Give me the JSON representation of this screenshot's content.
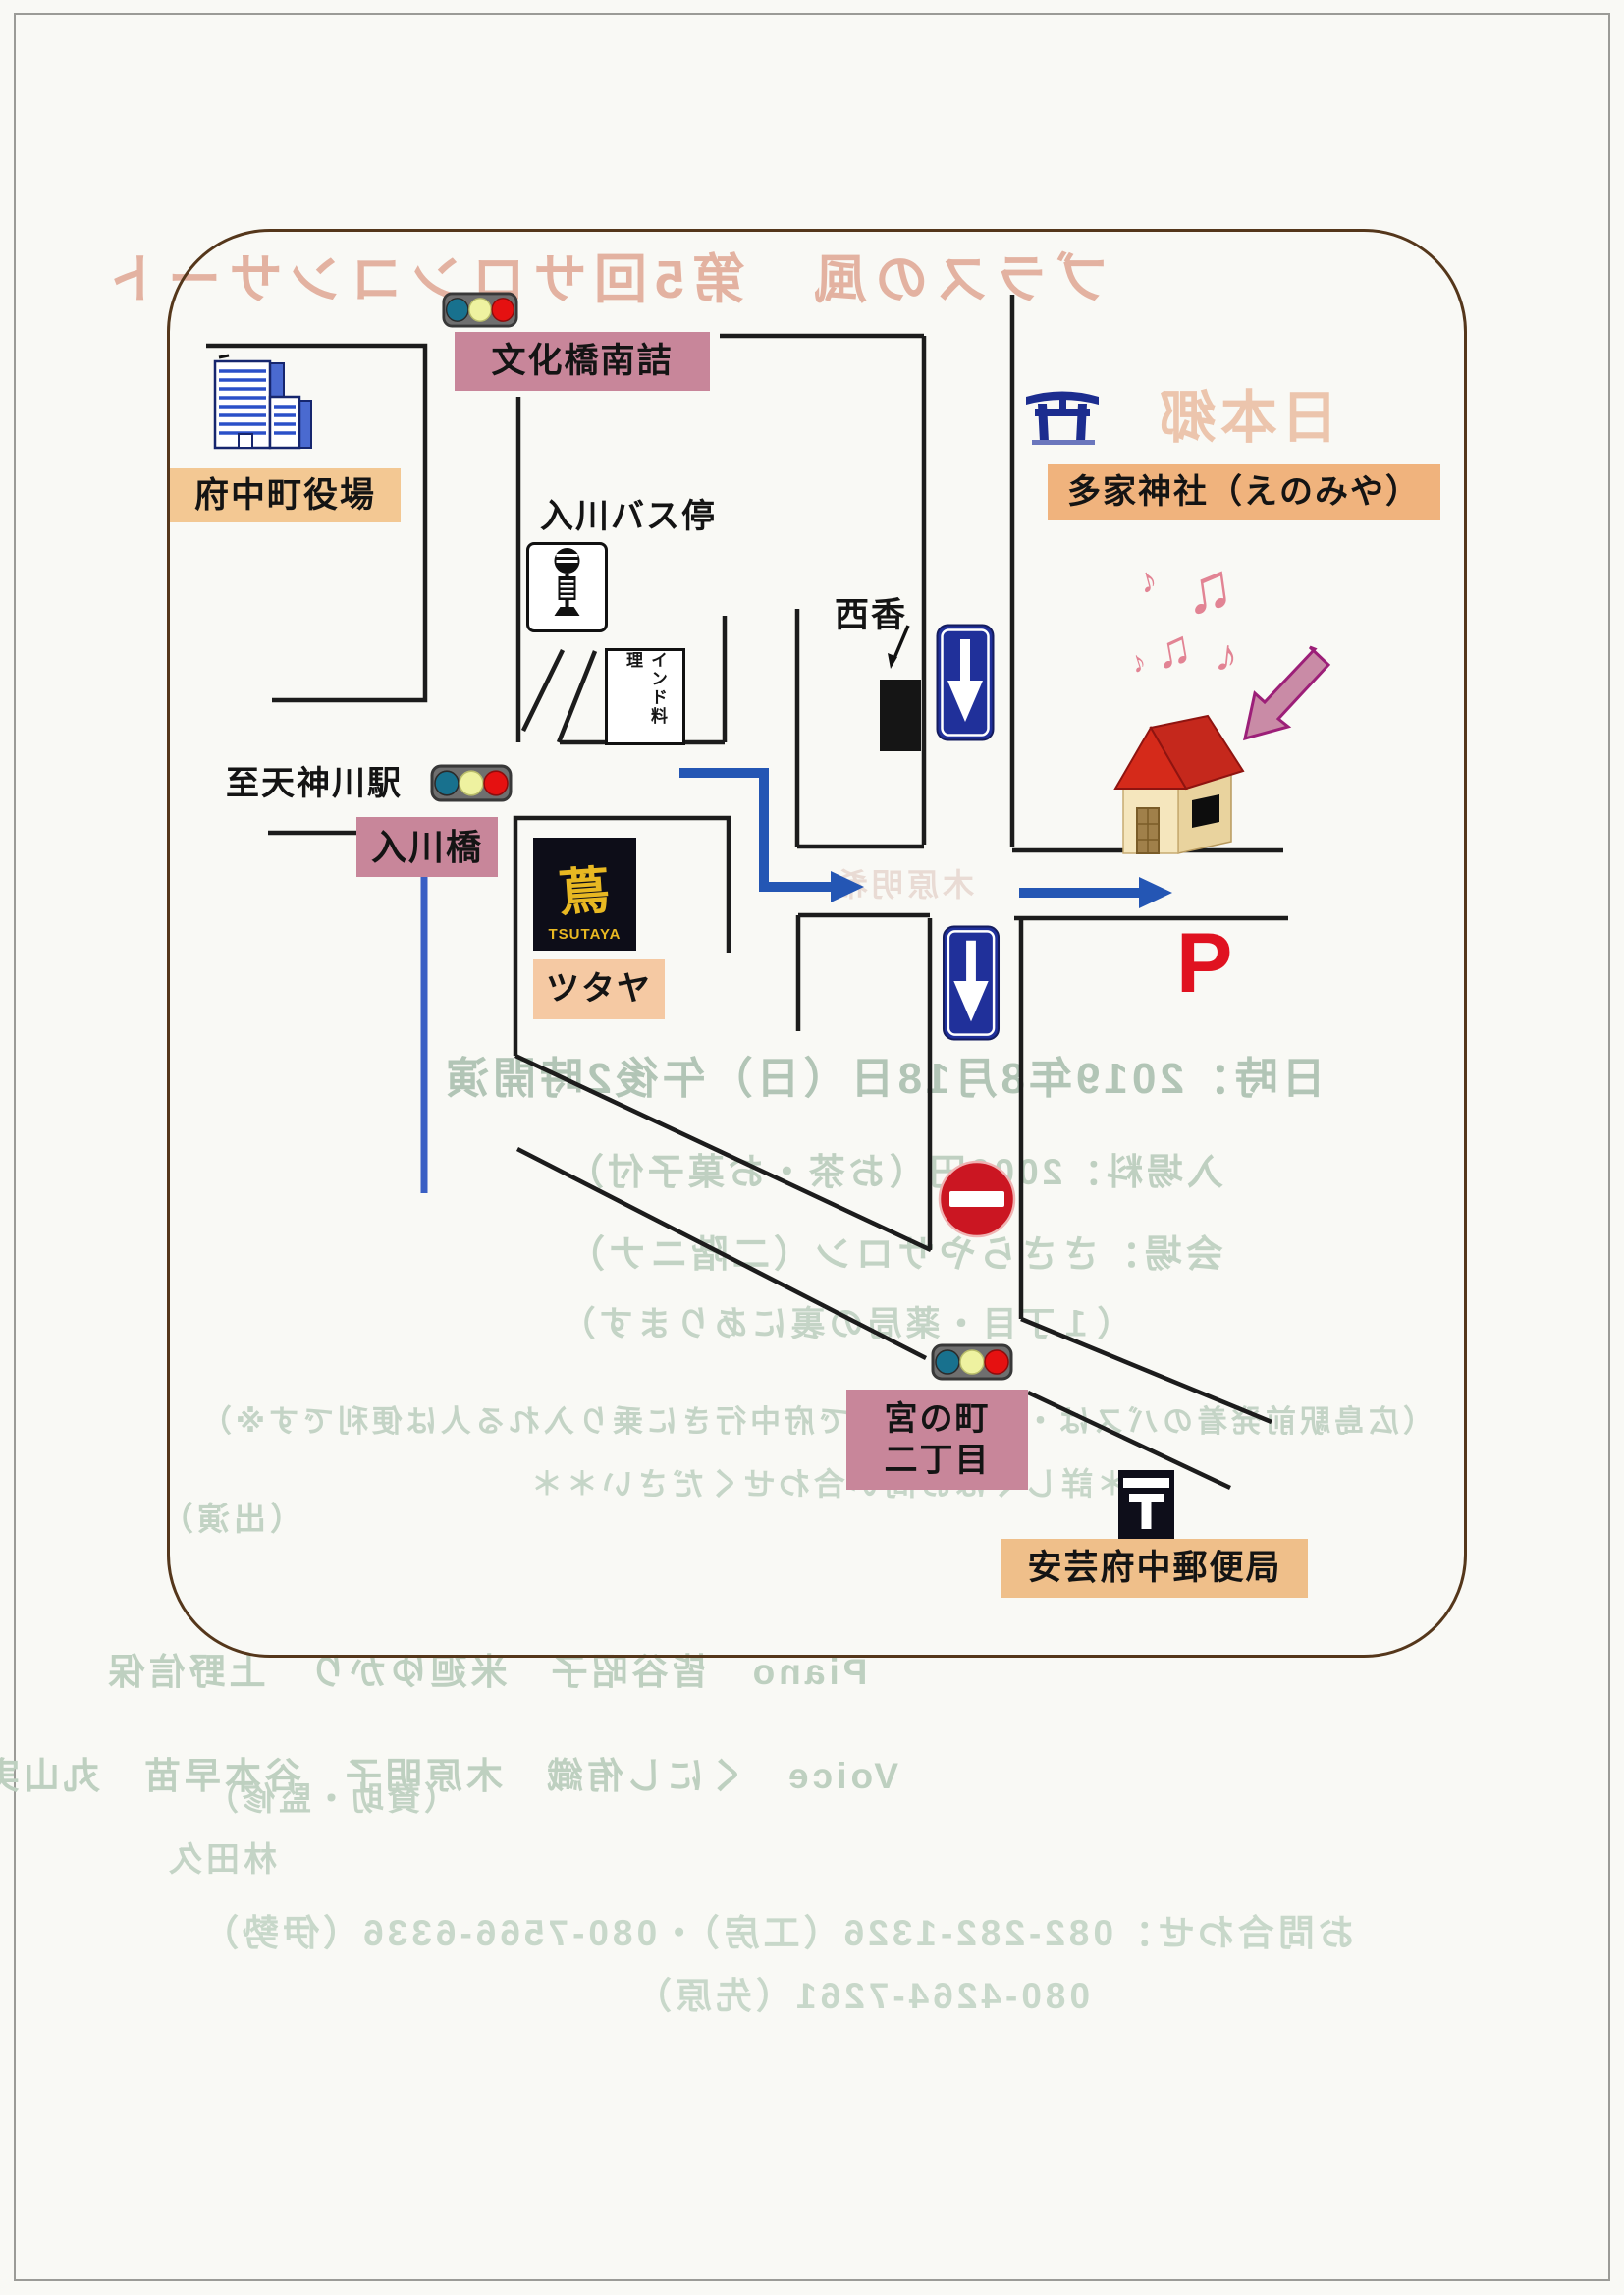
{
  "map": {
    "landmarks": {
      "bunkabashi_minamizume": "文化橋南詰",
      "fuchu_town_hall": "府中町役場",
      "irikawa_bus_stop": "入川バス停",
      "indian_restaurant": "インド料理",
      "nishika": "西香",
      "taka_shrine": "多家神社（えのみや）",
      "to_tenjingawa_station": "至天神川駅",
      "irikawa_bridge": "入川橋",
      "tsutaya_glyph": "蔦",
      "tsutaya_logo": "TSUTAYA",
      "tsutaya": "ツタヤ",
      "parking": "P",
      "miyanomachi_1": "宮の町",
      "miyanomachi_2": "二丁目",
      "aki_fuchu_post_office": "安芸府中郵便局"
    },
    "music_notes": [
      "♫",
      "♪",
      "♫",
      "♪",
      "♪"
    ],
    "colors": {
      "label_pink": "#c8869a",
      "label_orange": "#f3c893",
      "label_orange_deep": "#f0b37d",
      "road_black": "#1c1c1c",
      "route_blue": "#2456b4",
      "river_blue": "#3a5fc4",
      "oneway_sign_blue": "#20309a",
      "no_entry_red": "#cc1420",
      "parking_red": "#e01220",
      "map_border_brown": "#55371b",
      "house_roof_red": "#d52a1a",
      "tsutaya_yellow": "#e8b822"
    }
  },
  "ghost_text": {
    "title": "ブラスの風　第5回サロンコンサート",
    "shrine_fragment": "日本郷",
    "kihara_fragment": "木原明希",
    "datetime": "日時：2019年8月18日（日）午後2時開演",
    "fee": "入場料：2000円（お茶・お菓子付）",
    "venue": "会場：ささらやサロン（二階ニナ）",
    "access": "（１丁目・薬局の裏にあります）",
    "bus_note": "（広島駅前発着のバスは・文化橋下車で府中行きに乗り入れる人は便利です※）",
    "ask_note": "＊＊詳しくはお問い合わせください＊＊",
    "shutsuen": "（出演）",
    "piano_line": "Piano　皆谷昭子　米廻ゆかり　上野信保",
    "voice_line": "Voice　くにし侑織　木原明子　谷本早苗　丸山実生",
    "sanjo": "（賛助・監修）",
    "daihyo": "林田久",
    "tel_line1": "お問合わせ：082-282-1326（工房）・080-7566-6336（伊勢）",
    "tel_line2": "080-4264-7261（先原）"
  }
}
